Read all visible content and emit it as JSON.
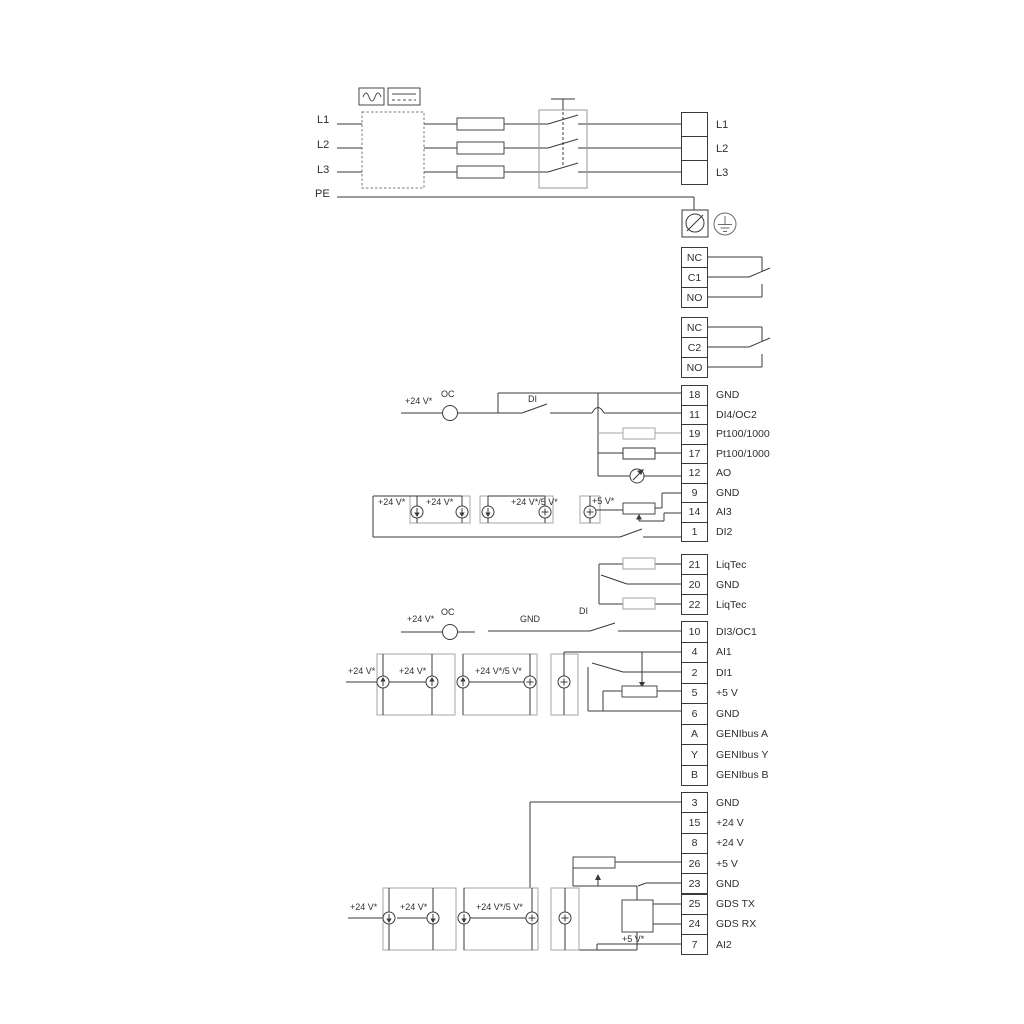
{
  "colors": {
    "wire": "#3a3a3a",
    "grey": "#a6a6a6"
  },
  "power_in": {
    "l1": "L1",
    "l2": "L2",
    "l3": "L3",
    "pe": "PE"
  },
  "mains_out": [
    {
      "label": "L1"
    },
    {
      "label": "L2"
    },
    {
      "label": "L3"
    }
  ],
  "relay1": [
    {
      "num": "NC"
    },
    {
      "num": "C1"
    },
    {
      "num": "NO"
    }
  ],
  "relay2": [
    {
      "num": "NC"
    },
    {
      "num": "C2"
    },
    {
      "num": "NO"
    }
  ],
  "io1": [
    {
      "num": "18",
      "label": "GND"
    },
    {
      "num": "11",
      "label": "DI4/OC2"
    },
    {
      "num": "19",
      "label": "Pt100/1000"
    },
    {
      "num": "17",
      "label": "Pt100/1000"
    },
    {
      "num": "12",
      "label": "AO"
    },
    {
      "num": "9",
      "label": "GND"
    },
    {
      "num": "14",
      "label": "AI3"
    },
    {
      "num": "1",
      "label": "DI2"
    }
  ],
  "liqtec": [
    {
      "num": "21",
      "label": "LiqTec"
    },
    {
      "num": "20",
      "label": "GND"
    },
    {
      "num": "22",
      "label": "LiqTec"
    }
  ],
  "io2": [
    {
      "num": "10",
      "label": "DI3/OC1"
    },
    {
      "num": "4",
      "label": "AI1"
    },
    {
      "num": "2",
      "label": "DI1"
    },
    {
      "num": "5",
      "label": "+5 V"
    },
    {
      "num": "6",
      "label": "GND"
    },
    {
      "num": "A",
      "label": "GENIbus A"
    },
    {
      "num": "Y",
      "label": "GENIbus Y"
    },
    {
      "num": "B",
      "label": "GENIbus B"
    }
  ],
  "io3": [
    {
      "num": "3",
      "label": "GND"
    },
    {
      "num": "15",
      "label": "+24 V"
    },
    {
      "num": "8",
      "label": "+24 V"
    },
    {
      "num": "26",
      "label": "+5 V"
    },
    {
      "num": "23",
      "label": "GND"
    },
    {
      "num": "25",
      "label": "GDS TX"
    },
    {
      "num": "24",
      "label": "GDS RX"
    },
    {
      "num": "7",
      "label": "AI2"
    }
  ],
  "ann": {
    "di4": {
      "v24": "+24 V*",
      "oc": "OC",
      "di": "DI"
    },
    "ai3": {
      "v24a": "+24 V*",
      "v24b": "+24 V*",
      "v24_5": "+24 V*/5 V*",
      "v5": "+5 V*"
    },
    "di3": {
      "v24": "+24 V*",
      "oc": "OC",
      "gnd": "GND",
      "di": "DI"
    },
    "ai1": {
      "v24a": "+24 V*",
      "v24b": "+24 V*",
      "v24_5": "+24 V*/5 V*"
    },
    "ai2": {
      "v24a": "+24 V*",
      "v24b": "+24 V*",
      "v24_5": "+24 V*/5 V*",
      "v5": "+5 V*"
    }
  }
}
